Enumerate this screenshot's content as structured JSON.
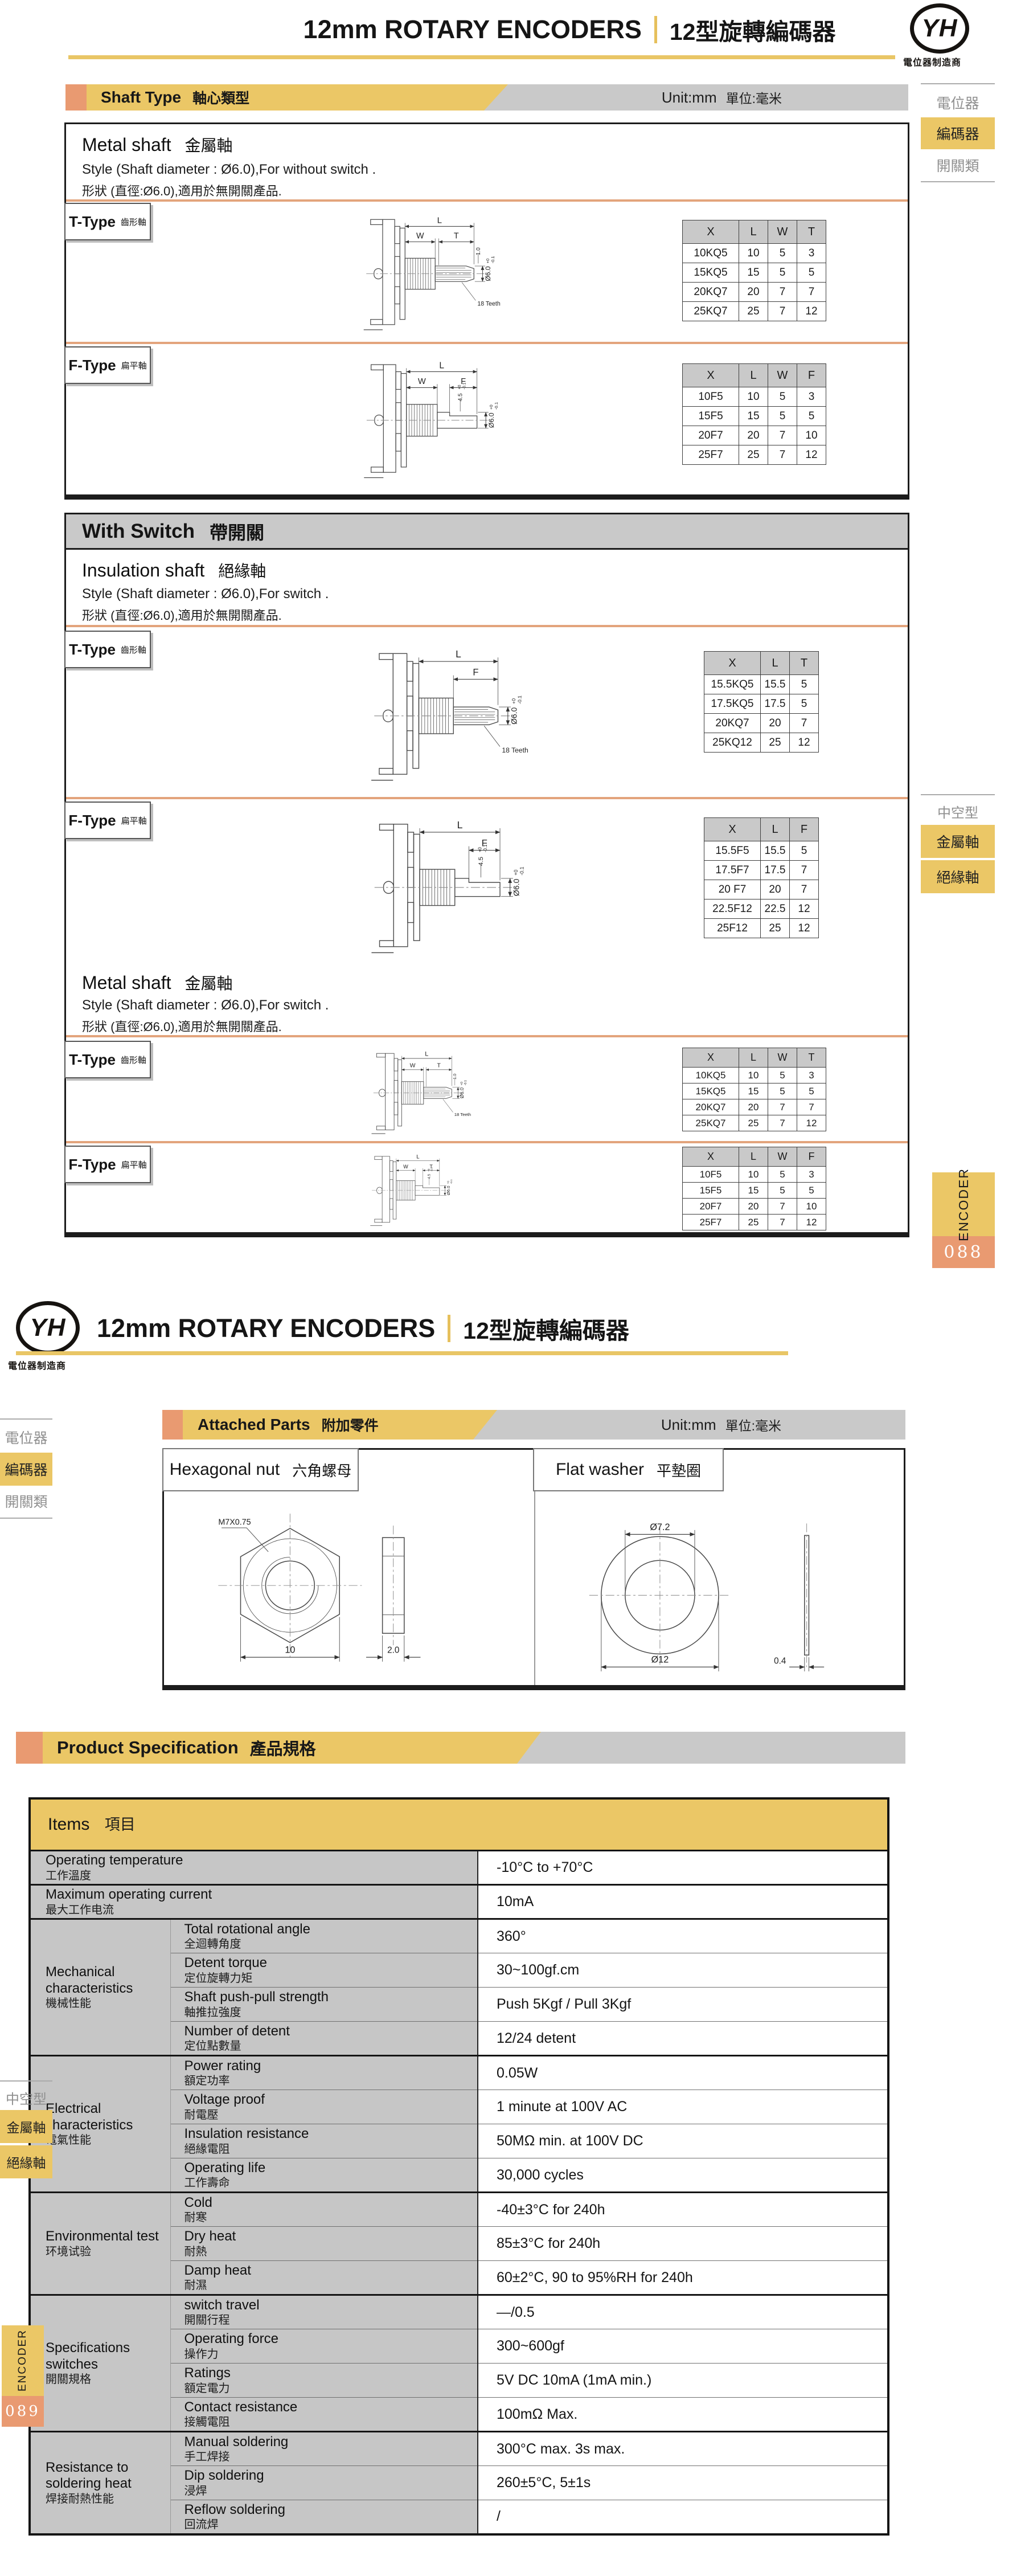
{
  "colors": {
    "gold": "#ebc766",
    "salmon": "#e99a71",
    "silver": "#c9c9c9",
    "cell_gray": "#c6c6c6"
  },
  "common": {
    "brand": {
      "logo": "YH",
      "tagline": "電位器制造商"
    },
    "title_en": "12mm ROTARY ENCODERS",
    "title_zh": "12型旋轉編碼器",
    "unit_en": "Unit:mm",
    "unit_zh": "單位:毫米",
    "nav_top": {
      "items": [
        {
          "label": "電位器",
          "active": false
        },
        {
          "label": "編碼器",
          "active": true
        },
        {
          "label": "開關類",
          "active": false
        }
      ]
    },
    "nav_mid": {
      "heading": "中空型",
      "items": [
        {
          "label": "金屬軸"
        },
        {
          "label": "絕緣軸"
        }
      ]
    },
    "badge_label": "ENCODER"
  },
  "page1": {
    "page_no": "088",
    "bar": {
      "en": "Shaft Type",
      "zh": "軸心類型"
    },
    "metal": {
      "title_en": "Metal shaft",
      "title_zh": "金屬軸",
      "style_en": "Style (Shaft diameter : Ø6.0),For without switch .",
      "style_zh": "形狀 (直徑:Ø6.0),適用於無開關產品.",
      "t": {
        "label_en": "T-Type",
        "label_zh": "齒形軸",
        "headers": [
          "X",
          "L",
          "W",
          "T"
        ],
        "rows": [
          [
            "10KQ5",
            "10",
            "5",
            "3"
          ],
          [
            "15KQ5",
            "15",
            "5",
            "5"
          ],
          [
            "20KQ7",
            "20",
            "7",
            "7"
          ],
          [
            "25KQ7",
            "25",
            "7",
            "12"
          ]
        ]
      },
      "f": {
        "label_en": "F-Type",
        "label_zh": "扁平軸",
        "headers": [
          "X",
          "L",
          "W",
          "F"
        ],
        "rows": [
          [
            "10F5",
            "10",
            "5",
            "3"
          ],
          [
            "15F5",
            "15",
            "5",
            "5"
          ],
          [
            "20F7",
            "20",
            "7",
            "10"
          ],
          [
            "25F7",
            "25",
            "7",
            "12"
          ]
        ]
      }
    },
    "ws_bar": {
      "en": "With Switch",
      "zh": "帶開關"
    },
    "insulation": {
      "title_en": "Insulation shaft",
      "title_zh": "絕緣軸",
      "style_en": "Style (Shaft diameter : Ø6.0),For switch .",
      "style_zh": "形狀 (直徑:Ø6.0),適用於無開關產品.",
      "t": {
        "label_en": "T-Type",
        "label_zh": "齒形軸",
        "headers": [
          "X",
          "L",
          "T"
        ],
        "rows": [
          [
            "15.5KQ5",
            "15.5",
            "5"
          ],
          [
            "17.5KQ5",
            "17.5",
            "5"
          ],
          [
            "20KQ7",
            "20",
            "7"
          ],
          [
            "25KQ12",
            "25",
            "12"
          ]
        ]
      },
      "f": {
        "label_en": "F-Type",
        "label_zh": "扁平軸",
        "headers": [
          "X",
          "L",
          "F"
        ],
        "rows": [
          [
            "15.5F5",
            "15.5",
            "5"
          ],
          [
            "17.5F7",
            "17.5",
            "7"
          ],
          [
            "20 F7",
            "20",
            "7"
          ],
          [
            "22.5F12",
            "22.5",
            "12"
          ],
          [
            "25F12",
            "25",
            "12"
          ]
        ]
      }
    },
    "metal_sw": {
      "title_en": "Metal shaft",
      "title_zh": "金屬軸",
      "style_en": "Style (Shaft diameter : Ø6.0),For switch .",
      "style_zh": "形狀 (直徑:Ø6.0),適用於無開關產品.",
      "t": {
        "label_en": "T-Type",
        "label_zh": "齒形軸",
        "headers": [
          "X",
          "L",
          "W",
          "T"
        ],
        "rows": [
          [
            "10KQ5",
            "10",
            "5",
            "3"
          ],
          [
            "15KQ5",
            "15",
            "5",
            "5"
          ],
          [
            "20KQ7",
            "20",
            "7",
            "7"
          ],
          [
            "25KQ7",
            "25",
            "7",
            "12"
          ]
        ]
      },
      "f": {
        "label_en": "F-Type",
        "label_zh": "扁平軸",
        "headers": [
          "X",
          "L",
          "W",
          "F"
        ],
        "rows": [
          [
            "10F5",
            "10",
            "5",
            "3"
          ],
          [
            "15F5",
            "15",
            "5",
            "5"
          ],
          [
            "20F7",
            "20",
            "7",
            "10"
          ],
          [
            "25F7",
            "25",
            "7",
            "12"
          ]
        ]
      }
    },
    "drawings": {
      "d1": {
        "type": "T",
        "L": "L",
        "W": "W",
        "R": "T",
        "dia": "Ø6.0",
        "dia_u": "+0",
        "dia_d": "-0.1",
        "top": "1.0",
        "teeth": "18 Teeth"
      },
      "d2": {
        "type": "F",
        "L": "L",
        "W": "W",
        "R": "F",
        "dia": "Ø6.0",
        "dia_u": "+0",
        "dia_d": "-0.1",
        "top": "4.5",
        "top_u": "+0",
        "top_d": "-0.1"
      },
      "d3": {
        "type": "T",
        "L": "L",
        "R": "F",
        "dia": "Ø6.0",
        "dia_u": "+0",
        "dia_d": "-0.1",
        "teeth": "18 Teeth"
      },
      "d4": {
        "type": "F",
        "L": "L",
        "R": "F",
        "dia": "Ø6.0",
        "dia_u": "+0",
        "dia_d": "-0.1",
        "top": "4.5",
        "top_u": "+0",
        "top_d": "-0.1"
      },
      "d5": {
        "type": "T",
        "L": "L",
        "W": "W",
        "R": "T",
        "dia": "Ø6.0",
        "dia_u": "+0",
        "dia_d": "-0.1",
        "top": "1.0",
        "teeth": "18 Teeth"
      },
      "d6": {
        "type": "F",
        "L": "L",
        "W": "W",
        "R": "T",
        "dia": "Ø6.0",
        "dia_u": "+0",
        "dia_d": "-0.1",
        "top": "4.5",
        "top_u": "+0",
        "top_d": "-0.1"
      }
    }
  },
  "page2": {
    "page_no": "089",
    "bar": {
      "en": "Attached Parts",
      "zh": "附加零件"
    },
    "nut": {
      "title_en": "Hexagonal nut",
      "title_zh": "六角螺母",
      "thread": "M7X0.75",
      "width": "10",
      "thickness": "2.0"
    },
    "washer": {
      "title_en": "Flat washer",
      "title_zh": "平墊圈",
      "inner": "Ø7.2",
      "outer": "Ø12",
      "thickness": "0.4"
    },
    "spec_bar": {
      "en": "Product Specification",
      "zh": "產品規格"
    },
    "spec": {
      "header_en": "Items",
      "header_zh": "項目",
      "groups": [
        {
          "en": "Operating temperature",
          "zh": "工作溫度",
          "value": "-10°C to +70°C"
        },
        {
          "en": "Maximum operating current",
          "zh": "最大工作电流",
          "value": "10mA"
        },
        {
          "en": "Mechanical characteristics",
          "zh": "機械性能",
          "subs": [
            {
              "en": "Total rotational angle",
              "zh": "全迴轉角度",
              "value": "360°"
            },
            {
              "en": "Detent torque",
              "zh": "定位旋轉力矩",
              "value": "30~100gf.cm"
            },
            {
              "en": "Shaft push-pull strength",
              "zh": "軸推拉強度",
              "value": "Push 5Kgf / Pull 3Kgf"
            },
            {
              "en": "Number of detent",
              "zh": "定位點數量",
              "value": "12/24 detent"
            }
          ]
        },
        {
          "en": "Electrical characteristics",
          "zh": "電氣性能",
          "subs": [
            {
              "en": "Power rating",
              "zh": "額定功率",
              "value": "0.05W"
            },
            {
              "en": "Voltage proof",
              "zh": "耐電壓",
              "value": "1 minute at 100V AC"
            },
            {
              "en": "Insulation resistance",
              "zh": "絕緣電阻",
              "value": "50MΩ min. at 100V DC"
            },
            {
              "en": "Operating life",
              "zh": "工作壽命",
              "value": "30,000 cycles"
            }
          ]
        },
        {
          "en": "Environmental test",
          "zh": "环境试验",
          "subs": [
            {
              "en": "Cold",
              "zh": "耐寒",
              "value": "-40±3°C for 240h"
            },
            {
              "en": "Dry heat",
              "zh": "耐熱",
              "value": "85±3°C for 240h"
            },
            {
              "en": "Damp heat",
              "zh": "耐濕",
              "value": "60±2°C, 90 to 95%RH for 240h"
            }
          ]
        },
        {
          "en": "Specifications switches",
          "zh": "開關規格",
          "subs": [
            {
              "en": "switch travel",
              "zh": "開關行程",
              "value": "—/0.5"
            },
            {
              "en": "Operating force",
              "zh": "操作力",
              "value": "300~600gf"
            },
            {
              "en": "Ratings",
              "zh": "額定電力",
              "value": "5V DC 10mA (1mA min.)"
            },
            {
              "en": "Contact resistance",
              "zh": "接觸電阻",
              "value": "100mΩ Max."
            }
          ]
        },
        {
          "en": "Resistance to soldering heat",
          "zh": "焊接耐熱性能",
          "subs": [
            {
              "en": "Manual soldering",
              "zh": "手工焊接",
              "value": "300°C max. 3s max."
            },
            {
              "en": "Dip soldering",
              "zh": "浸焊",
              "value": "260±5°C, 5±1s"
            },
            {
              "en": "Reflow soldering",
              "zh": "回流焊",
              "value": "/"
            }
          ]
        }
      ]
    }
  }
}
